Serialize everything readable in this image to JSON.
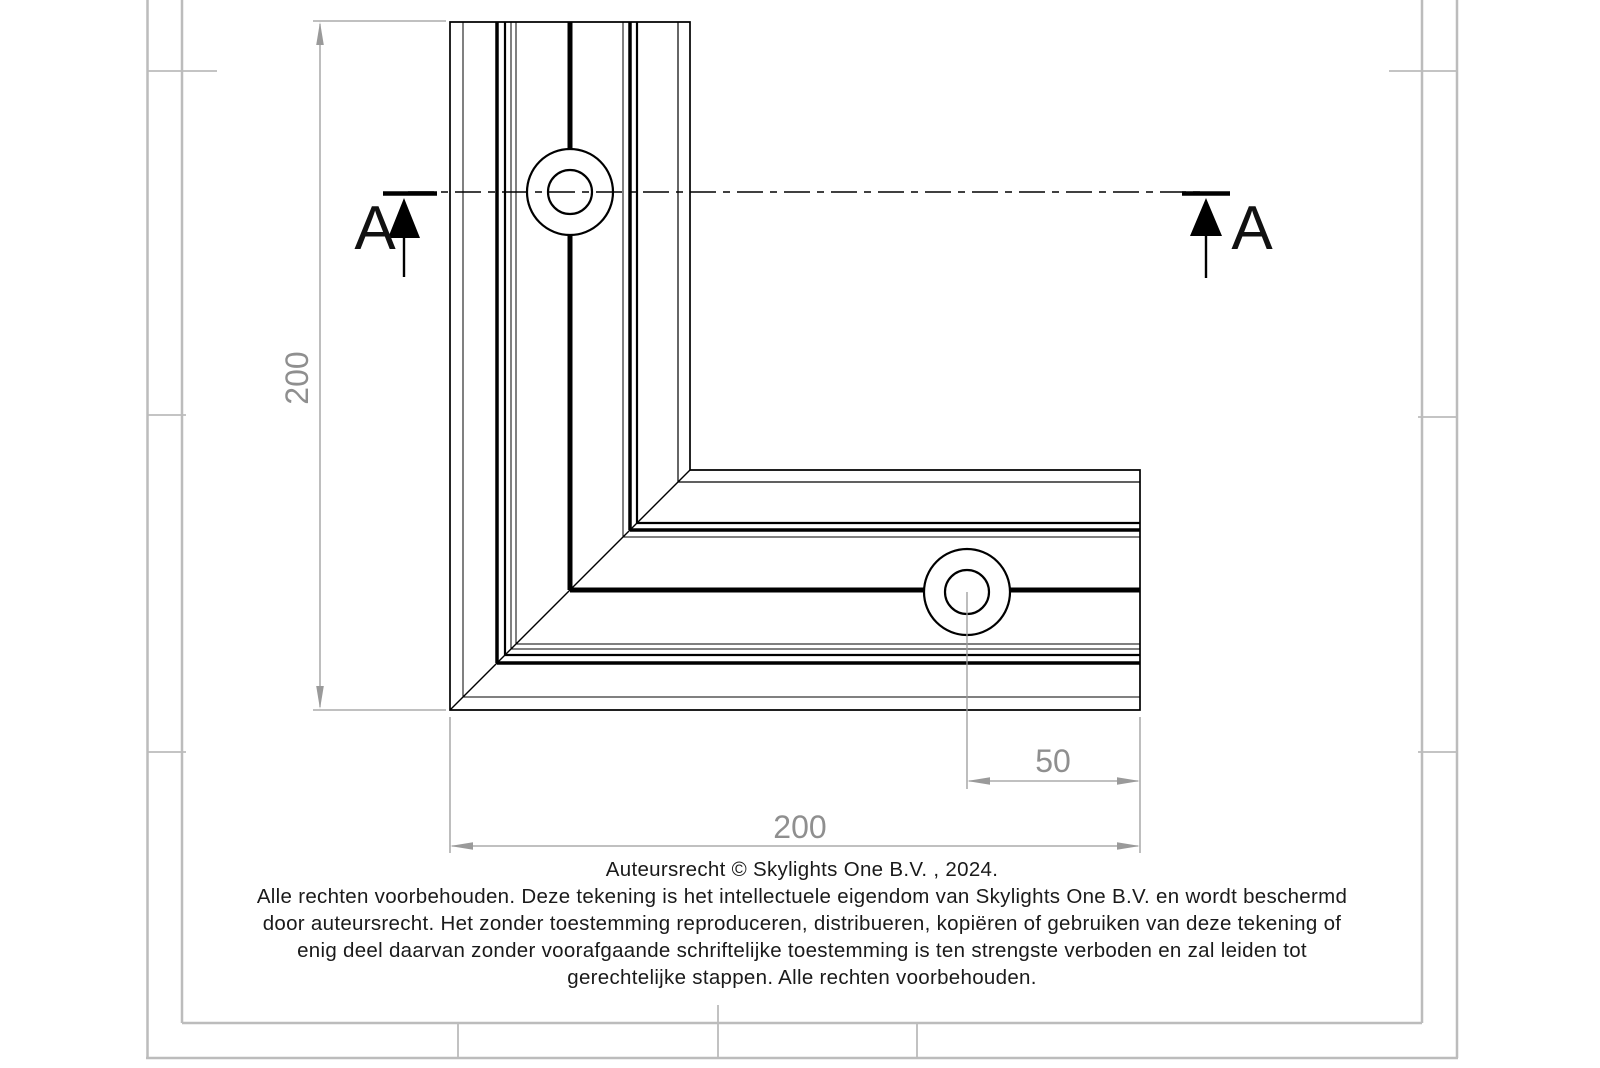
{
  "drawing": {
    "type_note": "corner profile technical drawing",
    "section": {
      "label_left": "A",
      "label_right": "A"
    },
    "dimensions": {
      "vertical_leg": "200",
      "horizontal_leg": "200",
      "hole_offset": "50"
    }
  },
  "copyright": {
    "lines": [
      "Auteursrecht © Skylights One B.V. , 2024.",
      "Alle rechten voorbehouden. Deze tekening is het intellectuele eigendom van Skylights One B.V. en wordt beschermd",
      "door auteursrecht. Het zonder toestemming reproduceren, distribueren, kopiëren of gebruiken van deze tekening of",
      "enig deel daarvan zonder voorafgaande schriftelijke toestemming is ten strengste verboden en zal leiden tot",
      "gerechtelijke stappen. Alle rechten voorbehouden."
    ]
  },
  "colors": {
    "drawing_line": "#000000",
    "dimension_gray": "#8f8f8f",
    "frame_gray": "#bcbcbc",
    "text": "#1a1a1a",
    "background": "#ffffff"
  }
}
